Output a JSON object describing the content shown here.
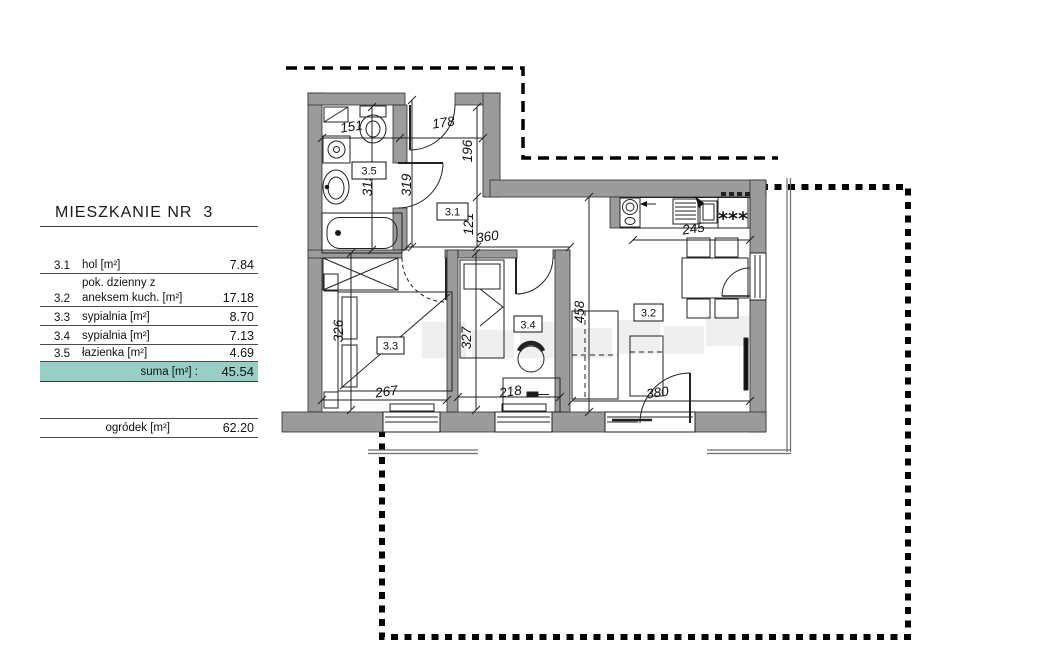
{
  "legend": {
    "title": "MIESZKANIE NR  3",
    "rows": [
      {
        "no": "3.1",
        "name": "hol [m²]",
        "value": "7.84"
      },
      {
        "no": "3.2",
        "name": "pok. dzienny z\naneksem kuch. [m²]",
        "value": "17.18"
      },
      {
        "no": "3.3",
        "name": "sypialnia [m²]",
        "value": "8.70"
      },
      {
        "no": "3.4",
        "name": "sypialnia [m²]",
        "value": "7.13"
      },
      {
        "no": "3.5",
        "name": "łazienka [m²]",
        "value": "4.69"
      }
    ],
    "suma": {
      "label": "suma [m²] :",
      "value": "45.54"
    },
    "garden": {
      "label": "ogródek [m²]",
      "value": "62.20"
    }
  },
  "plan": {
    "room_labels": {
      "hall": "3.1",
      "living": "3.2",
      "bedroom1": "3.3",
      "bedroom2": "3.4",
      "bathroom": "3.5"
    },
    "dims": {
      "bath_width": "151",
      "hall_width": "178",
      "hall_height": "196",
      "hall_passage": "121",
      "hall_length": "360",
      "bath_depth": "315",
      "hall_depth": "319",
      "counter": "245",
      "living_depth": "458",
      "bedroom1_width": "267",
      "bedroom1_depth": "326",
      "bedroom2_depth": "327",
      "desk_width": "218",
      "living_width": "380"
    },
    "stove_burners": "***"
  },
  "colors": {
    "suma_highlight": "#97cfc4",
    "wall_gray": "#9b9b9b"
  }
}
